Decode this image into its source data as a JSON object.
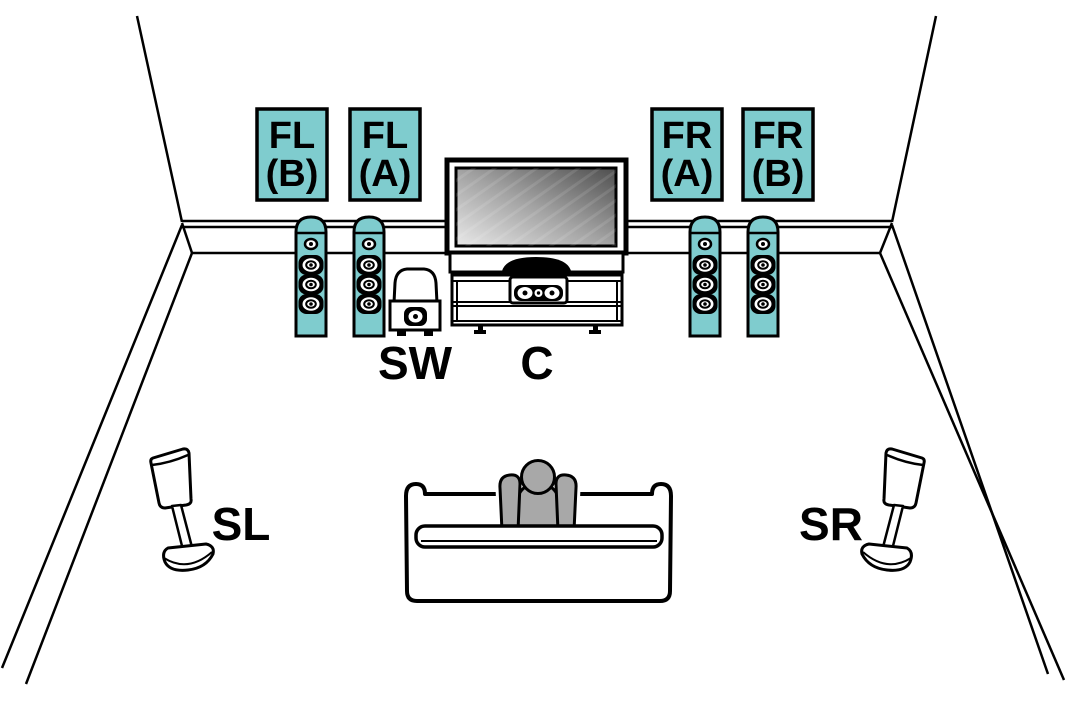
{
  "diagram_kind": "speaker-placement-room-diagram",
  "speaker_boxes": [
    {
      "id": "fl-b",
      "line1": "FL",
      "line2": "(B)"
    },
    {
      "id": "fl-a",
      "line1": "FL",
      "line2": "(A)"
    },
    {
      "id": "fr-a",
      "line1": "FR",
      "line2": "(A)"
    },
    {
      "id": "fr-b",
      "line1": "FR",
      "line2": "(B)"
    }
  ],
  "floor_labels": {
    "subwoofer": "SW",
    "center": "C",
    "surround_left": "SL",
    "surround_right": "SR"
  },
  "colors": {
    "speaker_highlight": "#7FCCCE",
    "person": "#A8A8A8",
    "outline": "#000000",
    "background": "#FFFFFF"
  }
}
